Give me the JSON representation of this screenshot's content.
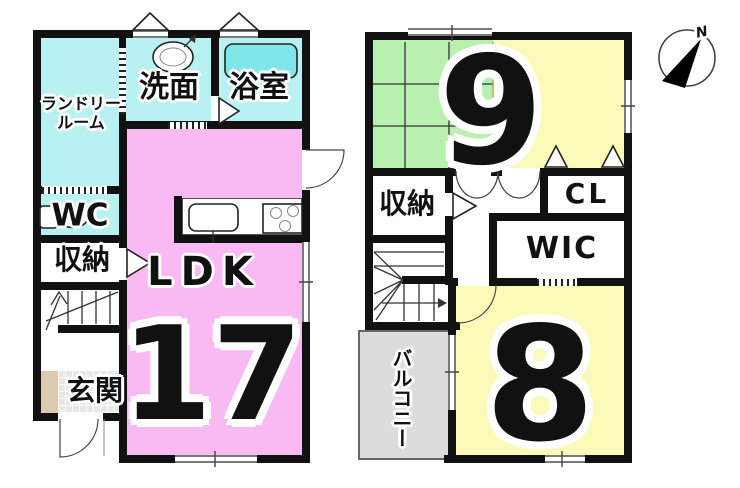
{
  "plan": {
    "floor1": {
      "laundry_line1": "ランドリー",
      "laundry_line2": "ルーム",
      "washroom": "洗面",
      "bathroom": "浴室",
      "wc": "WC",
      "storage": "収納",
      "entrance": "玄関",
      "ldk_label": "LDK",
      "ldk_size": "17"
    },
    "floor2": {
      "room9_size": "9",
      "storage": "収納",
      "closet": "CL",
      "walk_in_closet": "WIC",
      "balcony": "バルコニー",
      "room8_size": "8"
    },
    "compass_north": "N",
    "palette": {
      "wall": "#111111",
      "water_room": "#b9f1f2",
      "ldk": "#f9b9f2",
      "tatami_green": "#b9f0af",
      "bedroom_yellow": "#fbfab8",
      "bathtub": "#80e6ec",
      "balcony_gray": "#dcdcdc",
      "entrance_step_tan": "#d9cab0"
    }
  }
}
